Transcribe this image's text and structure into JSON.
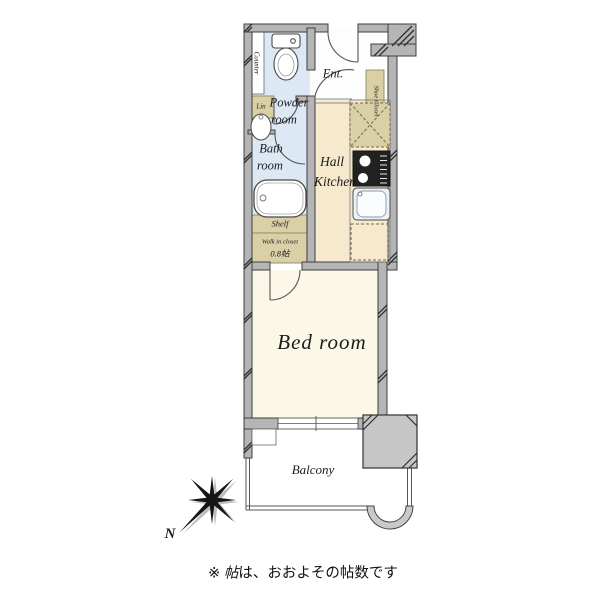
{
  "fp": {
    "rooms": {
      "powder": {
        "l1": "Powder",
        "l2": "room"
      },
      "bath": {
        "l1": "Bath",
        "l2": "room"
      },
      "hall_kitchen": {
        "l1": "Hall",
        "l2": "Kitchen"
      },
      "entrance": "Ent.",
      "bedroom": "Bed room",
      "balcony": "Balcony"
    },
    "storage": {
      "counter": "Counter",
      "linen": "Lin",
      "shoe_closet": "Shoe Closet",
      "shelf": "Shelf",
      "wic_label": "Walk in closet",
      "wic_size": "0.8帖"
    },
    "compass": {
      "north": "N"
    },
    "note": {
      "prefix": "※ ",
      "unit": "帖",
      "rest": "は、おおよその帖数です"
    },
    "colors": {
      "wet_area": "#dce8f3",
      "hall": "#f6e9ce",
      "closet": "#d9d0a6",
      "bedroom": "#fbf8e8",
      "wall_fill": "#b5b5b5",
      "wall_outline": "#3e3e3e",
      "fixture_outline": "#4a4a4a",
      "text": "#1c1c1c"
    }
  }
}
